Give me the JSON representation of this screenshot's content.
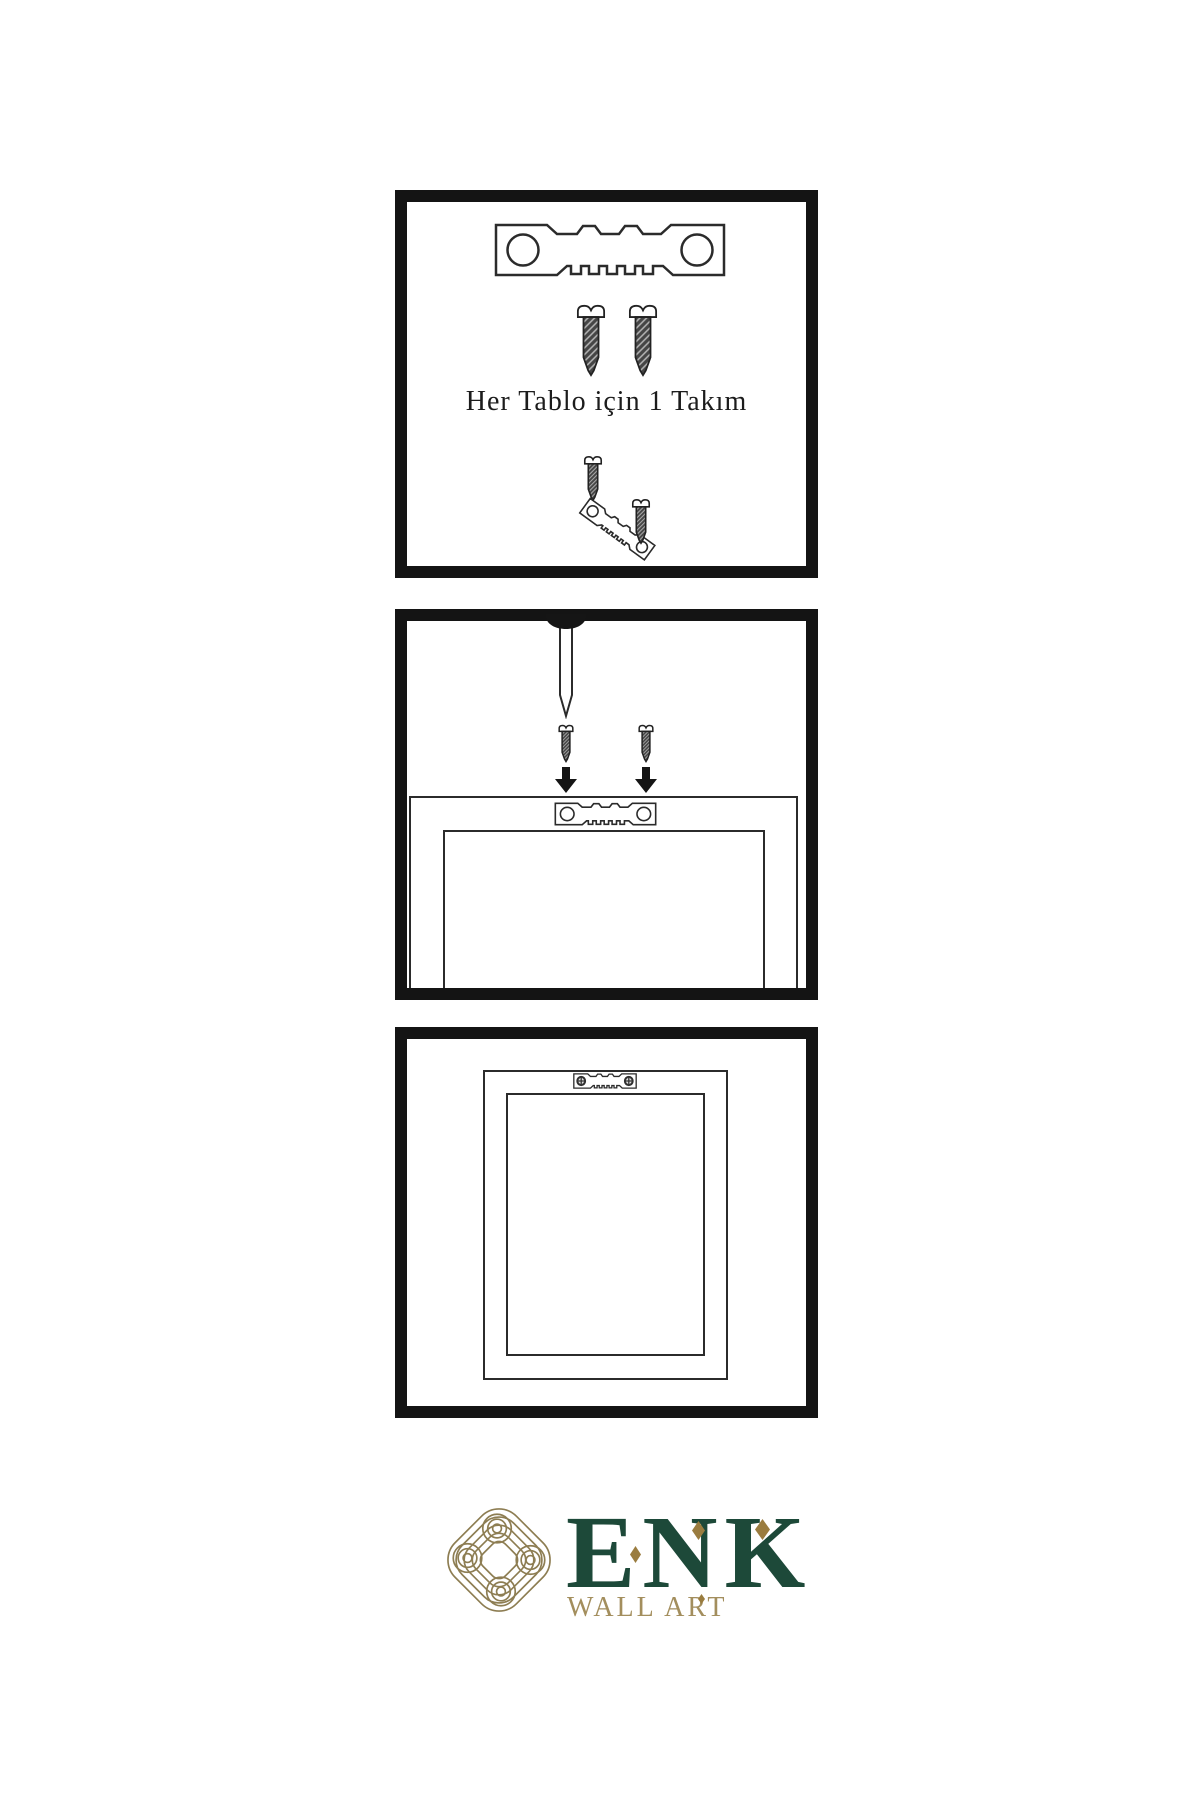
{
  "page": {
    "background": "#ffffff",
    "type": "wall-art hanging-hardware instruction sheet"
  },
  "steps": {
    "kit": {
      "caption": "Her Tablo için 1 Takım",
      "icons": [
        "sawtooth-hanger-icon",
        "screw-icon",
        "screw-icon",
        "screw-icon",
        "sawtooth-hanger-angled-icon",
        "screw-icon"
      ]
    },
    "mounting": {
      "icons": [
        "wall-nail-icon",
        "screw-icon",
        "screw-icon",
        "arrow-down-icon",
        "arrow-down-icon",
        "frame-back-icon",
        "sawtooth-hanger-icon"
      ]
    },
    "result": {
      "icons": [
        "frame-back-icon",
        "sawtooth-hanger-mounted-icon"
      ]
    }
  },
  "logo": {
    "brand": "ENK",
    "subtitle": "WALL ART",
    "mark": "interlaced-knot-icon"
  },
  "colors": {
    "line_art": "#2b2b2b",
    "panel_border": "#141414",
    "screw_body": "#454545",
    "brand_green": "#1d4939",
    "knot_gold": "#8d7d52",
    "accent_gold": "#9a7c3f",
    "subtitle_gold": "#a38e5d"
  }
}
